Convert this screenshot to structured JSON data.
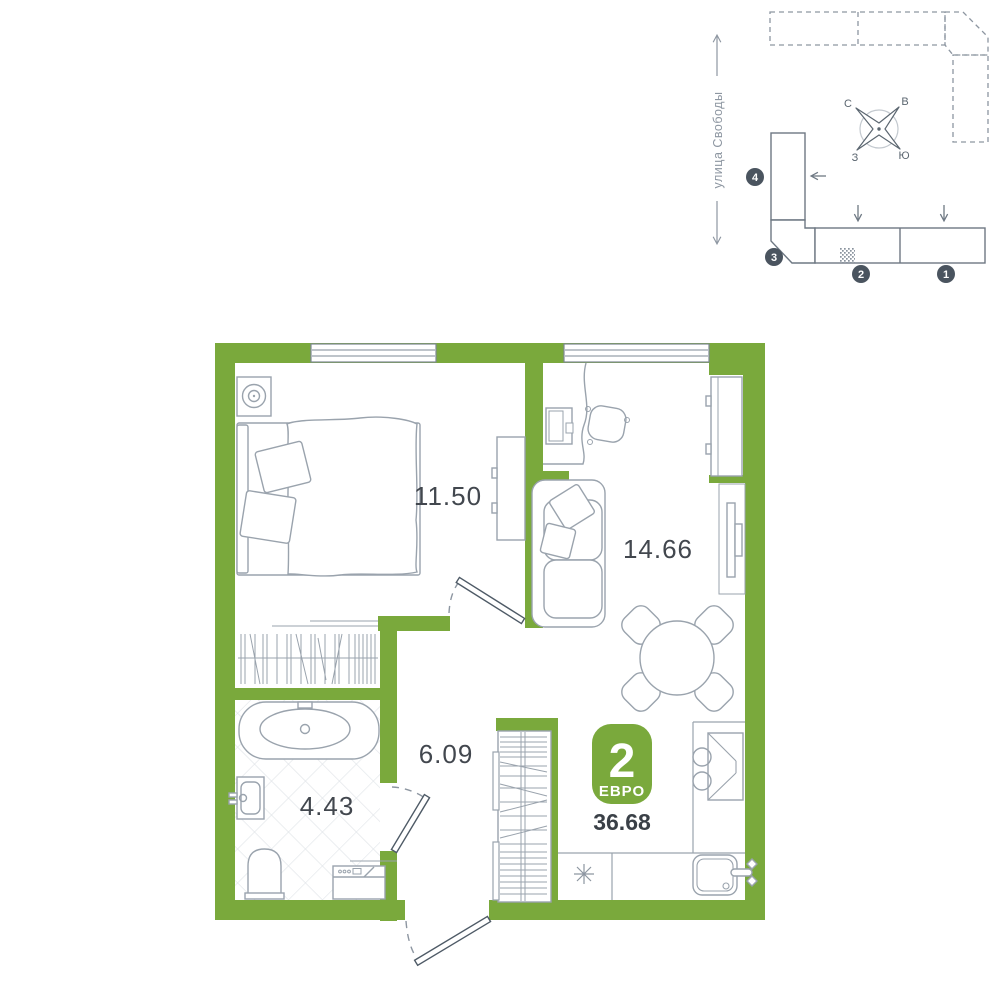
{
  "minimap": {
    "street_label": "улица Свободы",
    "compass": {
      "n": "С",
      "e": "В",
      "w": "З",
      "s": "Ю"
    },
    "sections": [
      {
        "number": "1"
      },
      {
        "number": "2"
      },
      {
        "number": "3"
      },
      {
        "number": "4"
      }
    ]
  },
  "plan": {
    "badge": {
      "rooms_count": "2",
      "type_label": "ЕВРО"
    },
    "total_area": "36.68",
    "rooms": [
      {
        "id": "bedroom",
        "area": "11.50"
      },
      {
        "id": "living-kitchen",
        "area": "14.66"
      },
      {
        "id": "hallway",
        "area": "6.09"
      },
      {
        "id": "bathroom",
        "area": "4.43"
      }
    ]
  },
  "colors": {
    "wall_green": "#7aa93c",
    "line_gray": "#9aa3ad",
    "dark_slate": "#4a545f",
    "text_dark": "#42474e"
  }
}
